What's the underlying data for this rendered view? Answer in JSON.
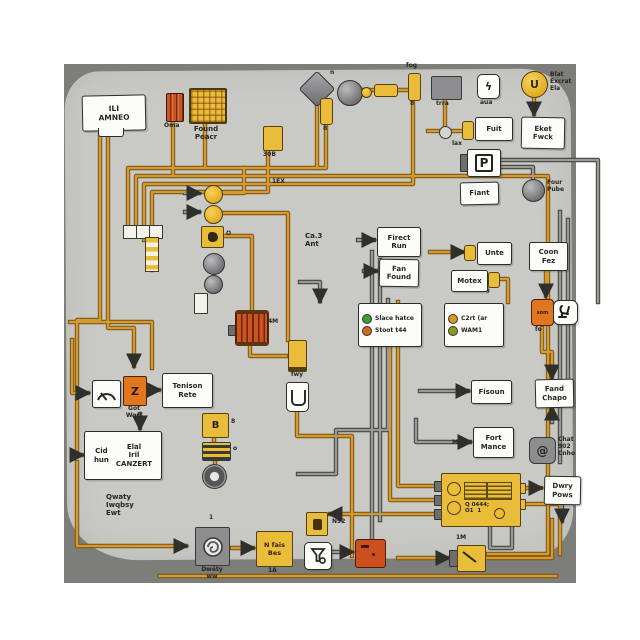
{
  "colors": {
    "frame": "#ffffff",
    "backdrop": "#7d7d7a",
    "paper": "#c9c9c5",
    "ink": "#26261f",
    "label_bg": "#fcfcfa",
    "wire_orange": "#d79a33",
    "wire_orange_outline": "#7c5a14",
    "wire_gray": "#9a9a95",
    "wire_gray_outline": "#45453f",
    "component_yellow": "#e9bc3a",
    "component_orange": "#e0771f",
    "component_red": "#cc4f1e",
    "component_gray": "#8d8d90",
    "green_dot": "#3a9e3a",
    "orange_dot": "#d2691e",
    "amber_dot": "#d69a1e",
    "olive_dot": "#8a9a1e"
  },
  "labels": {
    "unit": "ILI\nAMNEO",
    "oma": "Oma",
    "found": "Found\nPeacr",
    "trra": "trra",
    "aua": "aua",
    "fog": "fog",
    "v8a": "8",
    "v8b": "8",
    "v8c": "8",
    "blat": "Blat\nExcrat\nEla",
    "eket": "Eket\nFwck",
    "fuit": "Fuit",
    "lax": "lax",
    "fiant": "Fiant",
    "four": "Four\nPube",
    "firect": "Firect\nRun",
    "fan": "Fan\nFound",
    "ca3": "Ca.3\nAnt",
    "legend1_row1": "Slace hatce",
    "legend1_row2": "Stoot t44",
    "legend2_row1": "C2rt (ar",
    "legend2_row2": "WAM1",
    "om": "om §",
    "unte": "Unte",
    "motex": "Motex",
    "coon": "Coon\nFez",
    "fisoun": "Fisoun",
    "fand": "Fand\nChapo",
    "fort": "Fort\nMance",
    "m": "M",
    "chat": "Chat\n902\nCnho",
    "fo": "fo",
    "som": "som",
    "got": "Got\nWort",
    "tenison": "Tenison\nRete",
    "cid": "Cid\nhun",
    "elal": "Elal\nIril\nCANZERT",
    "qwaty": "Qwaty\nIwqbsy\nEwt",
    "o_small": "o",
    "one": "1",
    "dwety": "Dwéty\nww",
    "nfais": "N fais\nBes",
    "a1": "1A",
    "n92": "N92",
    "dwry": "Dwry\nPows",
    "m1": "1M",
    "b30": "30B",
    "ex1": "1EX",
    "m4": "4M",
    "fwy": "fwy",
    "oyel": "O",
    "n": "n",
    "ox": "o-",
    "ecu": "Q 0444;\nO1  1"
  },
  "glyphs": {
    "p": "P",
    "u": "U",
    "bolt": "ϟ",
    "swirl": "@",
    "z": "Z",
    "b": "B"
  }
}
